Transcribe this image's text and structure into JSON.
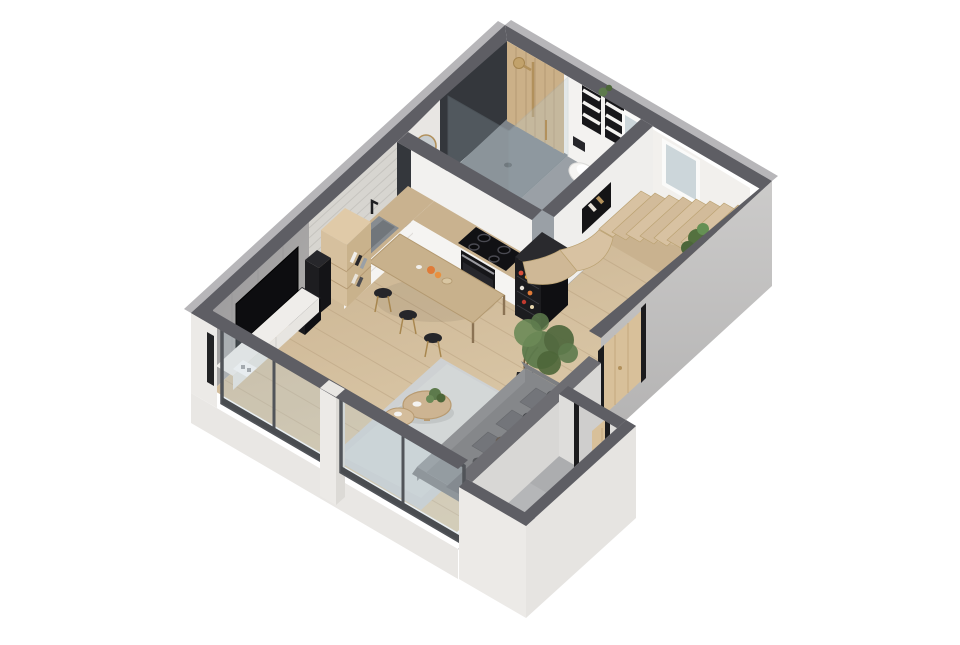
{
  "scene": {
    "kind": "3d-isometric-floorplan-render",
    "description": "Cutaway isometric 3D render of a small duplex studio apartment on a transparent background. No text labels are rendered.",
    "camera": "high south-east isometric, walls cut at uniform height with dark gray caps"
  },
  "palette": {
    "bg": "#ffffff",
    "wall_top": "#5e5e64",
    "wall_top_light": "#6d6d72",
    "wall_bevel": "#b7b6b9",
    "outer_white": "#e9e7e4",
    "outer_gray": "#c2c1c1",
    "inner_white": "#f2f0ed",
    "brick": "#d7d5d0",
    "brick_line": "#c6c4bf",
    "concrete": "#a4a3a1",
    "wood_floor": "#cdb795",
    "wood_floor_light": "#e0cdab",
    "plank_line": "#a98f6d",
    "bathroom_floor": "#9aa0a6",
    "shower_tray": "#7e848a",
    "bath_dark_wall": "#34373c",
    "wood_slat": "#cbb088",
    "stair_wood": "#d8c2a2",
    "stair_side": "#c9b28f",
    "counter_wood": "#c9b28f",
    "cabinet_white": "#f5f4f2",
    "appliance_black": "#1b1b1e",
    "cooktop_black": "#111114",
    "sink_gray": "#878c91",
    "glass_tint": "#b9cdd6",
    "frame_dark": "#515459",
    "door_wood": "#d8c09a",
    "door_post": "#1b1b1d",
    "sofa_gray": "#85878a",
    "sofa_back": "#6e7073",
    "cushion_gray": "#73757a",
    "rug_gray": "#ced1d3",
    "plant_green": "#5d7a4c",
    "plant_green_dark": "#4c6639",
    "pot_black": "#1e1e20",
    "brass": "#b2915c",
    "vestibule_floor": "#b5b6b8",
    "vestibule_wall": "#dedddb",
    "tv_black": "#0d0d10",
    "console_white": "#efedea",
    "marble": "#f3f2f0",
    "table_wood": "#c8b18c",
    "window_glass": "#ccd6da"
  },
  "floorplan": {
    "style": "isometric cutaway, single level with winder stair to upper floor",
    "rooms": [
      {
        "name": "bathroom",
        "position": "top corner (north)",
        "floor": "gray tile",
        "features": [
          "walk-in shower with glass enclosure",
          "wood slat accent wall",
          "brass shower column and head",
          "dark tiled wall",
          "dark vanity with round brass mirror",
          "black stool",
          "wall-hung toilet",
          "two black towel ladder shelves with white towels",
          "marble vanity counter with brass tap",
          "mirror window",
          "black wall niche with bottles"
        ]
      },
      {
        "name": "kitchen",
        "position": "along north-west brick wall",
        "floor": "light oak planks",
        "features": [
          "L-shaped counter",
          "gray undermount sink with black faucet",
          "induction cooktop with four rings",
          "built-in black oven",
          "black refrigerator with open door and groceries",
          "black coffee machine",
          "white flat-front cabinets",
          "whitewashed brick accent wall"
        ]
      },
      {
        "name": "living-dining",
        "position": "center and south-west",
        "floor": "light oak planks",
        "features": [
          "long oak dining table",
          "three black bar stools with brass legs",
          "concrete media wall",
          "wall-mounted TV",
          "white floating media console",
          "tall speaker and subwoofer",
          "oak bookshelf with books",
          "gray fabric sofa with cushions and pillows",
          "light gray rug",
          "two round oak nesting coffee tables",
          "potted indoor tree",
          "small table plant"
        ]
      },
      {
        "name": "stair-hall",
        "position": "east corner",
        "floor": "light oak planks",
        "features": [
          "winder staircase in light wood",
          "plant tucked under stair",
          "two white framed windows in north-east wall",
          "oak interior door with black jambs in south-east wall"
        ]
      },
      {
        "name": "entry-vestibule",
        "position": "south protrusion",
        "floor": "gray concrete",
        "features": [
          "white outer walls with dark caps",
          "oak entry door standing open with black jambs",
          "low gray wall behind sofa"
        ]
      },
      {
        "name": "glazed-facade",
        "position": "south-west edge",
        "features": [
          "floor-to-ceiling glazing in two bays",
          "dark gray frames and mullions",
          "white pillar and wall stub",
          "white plinth below floor slab"
        ]
      }
    ]
  }
}
